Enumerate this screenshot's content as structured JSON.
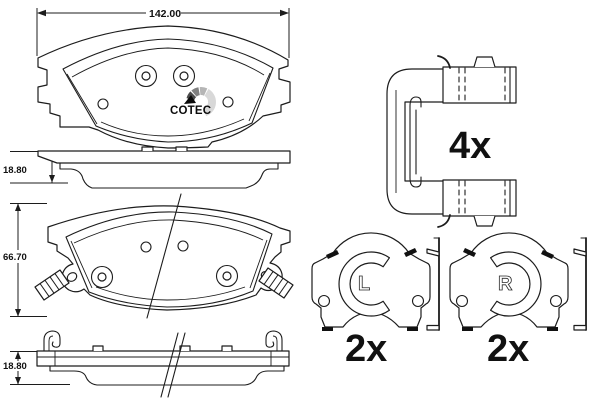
{
  "drawing": {
    "logo": {
      "text": "COTEC"
    },
    "dims": {
      "width": "142.00",
      "thickness_top": "18.80",
      "height": "66.70",
      "thickness_bottom": "18.80"
    },
    "qty": {
      "clips": "4x",
      "left_indicator": "2x",
      "right_indicator": "2x"
    },
    "side": {
      "left": "L",
      "right": "R"
    },
    "colors": {
      "friction": "#f3d6ba",
      "line": "#1c1c1c",
      "logo_dark": "#4a4a4a",
      "logo_mid": "#808080",
      "logo_light": "#b5b5b5",
      "logo_pale": "#d8d8d8"
    }
  }
}
